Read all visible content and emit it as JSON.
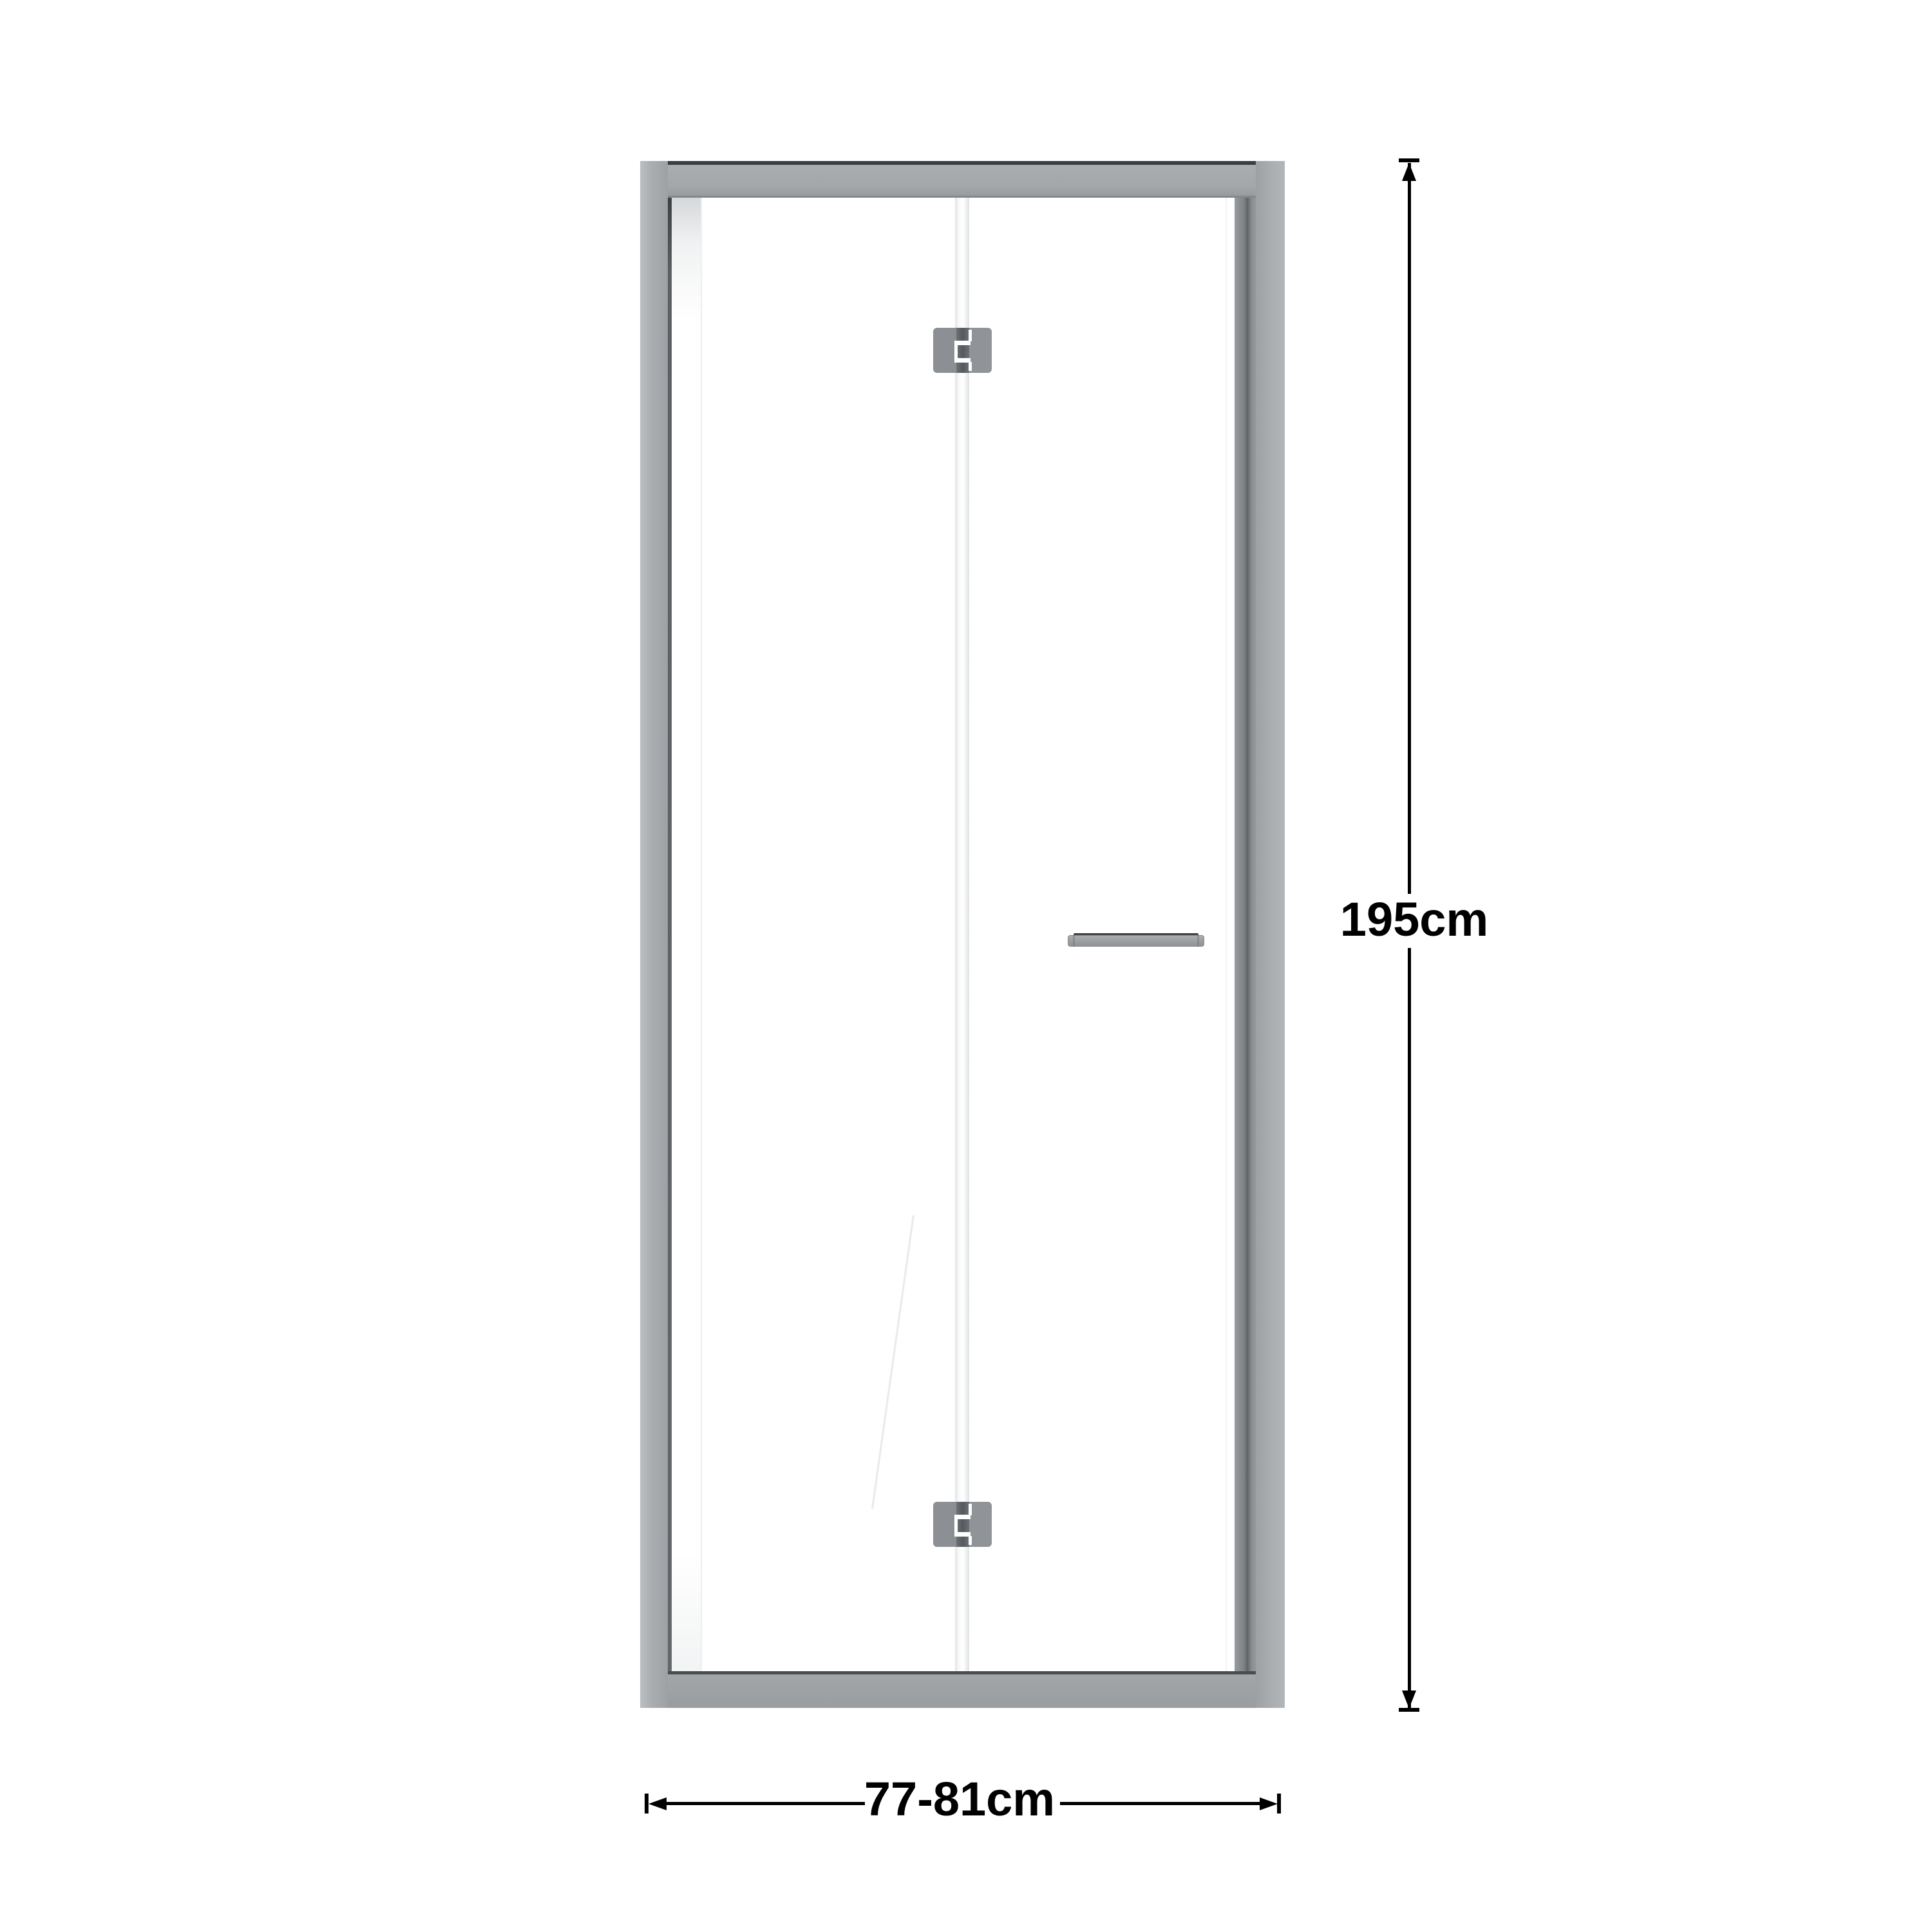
{
  "diagram": {
    "type": "product-dimension-diagram",
    "subject": "bi-fold shower door, front elevation",
    "height_label": "195cm",
    "width_label": "77-81cm"
  },
  "colors": {
    "dimension_line": "#000000",
    "frame_light": "#b5b8bb",
    "frame_mid": "#a3a7aa",
    "frame_dark": "#6f7376",
    "edge_dark": "#3c3f42",
    "hinge_leaf": "#8b8f93",
    "hinge_knuckle": "#55595d",
    "handle_body": "#9b9fa2",
    "handle_edge": "#3f4245",
    "glass": "#ffffff",
    "fold_line_edge": "#dfe1e2"
  }
}
